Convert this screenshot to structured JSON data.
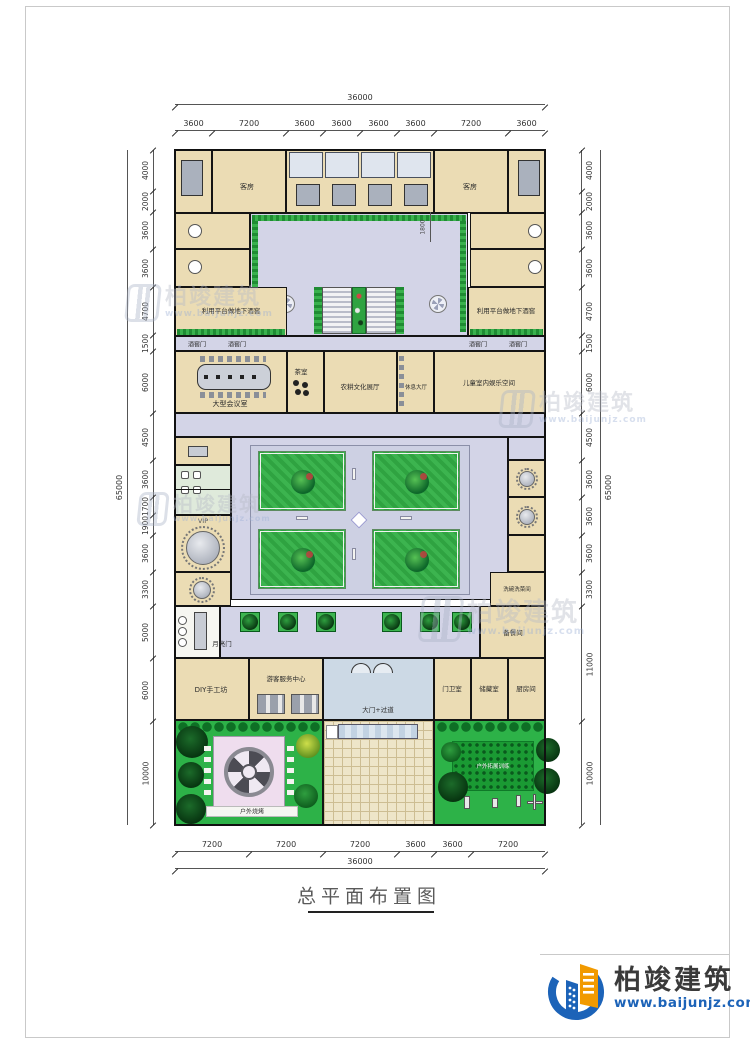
{
  "sheet": {
    "title": "总平面布置图",
    "logo": {
      "name": "柏竣建筑",
      "url": "www.baijunjz.com"
    },
    "watermark": {
      "name": "柏竣建筑",
      "url": "www.baijunjz.com"
    },
    "colors": {
      "room": "#ebdcb4",
      "corridor": "#d3d4e7",
      "garden": "#2db248",
      "brand_blue": "#1c63b8",
      "brand_orange": "#f19a00"
    }
  },
  "dims": {
    "top": {
      "total": "36000",
      "segments": [
        "3600",
        "7200",
        "3600",
        "3600",
        "3600",
        "3600",
        "7200",
        "3600"
      ]
    },
    "bottom": {
      "total": "36000",
      "segments": [
        "7200",
        "7200",
        "7200",
        "3600",
        "3600",
        "7200"
      ]
    },
    "left": {
      "total": "65000",
      "segments": [
        "4000",
        "2000",
        "3600",
        "3600",
        "4700",
        "1500",
        "6000",
        "4500",
        "3600",
        "1700",
        "1900",
        "3600",
        "3300",
        "5000",
        "6000",
        "10000"
      ]
    },
    "right": {
      "total": "65000",
      "segments": [
        "4000",
        "2000",
        "3600",
        "3600",
        "4700",
        "1500",
        "6000",
        "4500",
        "3600",
        "3600",
        "3600",
        "3300",
        "11000",
        "10000"
      ]
    },
    "corridor": "1800"
  },
  "labels": {
    "guest": "客房",
    "basement": "利用平台做地下酒窖",
    "cellar_door": "酒窖门",
    "conference": "大型会议室",
    "tea": "茶室",
    "exhibition": "农耕文化展厅",
    "lounge": "休息大厅",
    "kids": "儿童室内娱乐空间",
    "vip": "VIP",
    "wash": "洗碗洗菜间",
    "pantry": "备餐间",
    "moon": "月亮门",
    "diy": "DIY手工坊",
    "visitor": "游客服务中心",
    "gate": "大门+过道",
    "guard": "门卫室",
    "storage": "储藏室",
    "kitchen": "厨房间",
    "bbq": "户外烧烤",
    "training": "户外拓展训练"
  }
}
